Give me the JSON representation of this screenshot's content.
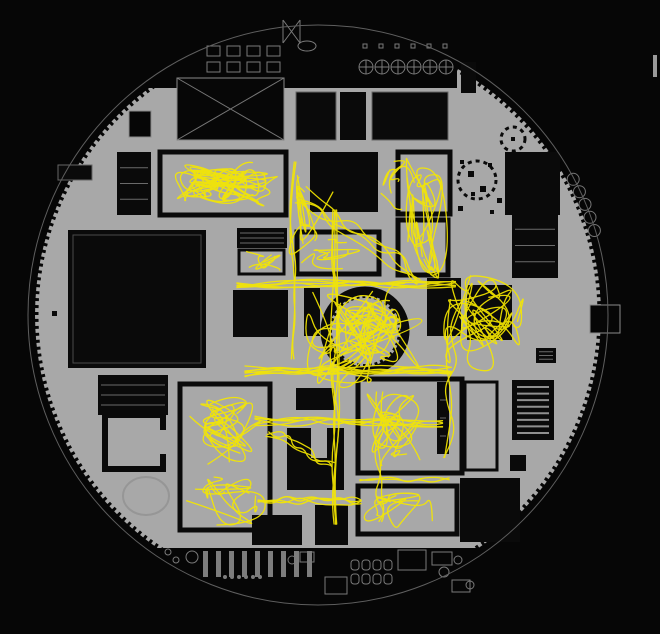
{
  "meta": {
    "description": "Circular office floor plan with yellow movement traces overlaid",
    "canvas": {
      "width": 660,
      "height": 634
    }
  },
  "colors": {
    "background": "#060606",
    "plate": "#a8a8a8",
    "room": "#0a0a0a",
    "outline_stroke": "#5f5f5f",
    "furniture_stroke": "#7a7a7a",
    "furniture_fill": "#7d7d7d",
    "detail_stroke": "#6a6a6a",
    "trace": "#f5e700"
  },
  "plan": {
    "plate": {
      "cx": 318,
      "cy": 315,
      "r": 283
    },
    "outline": {
      "cx": 318,
      "cy": 315,
      "r": 290
    },
    "rim_tick": {
      "dash": "3 4",
      "width": 7
    },
    "top_band": {
      "x": 0,
      "y": 0,
      "w": 457,
      "h": 88
    },
    "bottom_band": {
      "x": 0,
      "y": 548,
      "w": 660,
      "h": 86
    },
    "rooms": [
      {
        "x": 296,
        "y": 92,
        "w": 40,
        "h": 48,
        "t": "solid",
        "s": 1
      },
      {
        "x": 340,
        "y": 92,
        "w": 26,
        "h": 48,
        "t": "solid"
      },
      {
        "x": 372,
        "y": 92,
        "w": 76,
        "h": 48,
        "t": "solid",
        "s": 1
      },
      {
        "x": 461,
        "y": 62,
        "w": 15,
        "h": 31,
        "t": "solid"
      },
      {
        "x": 129,
        "y": 111,
        "w": 22,
        "h": 26,
        "t": "thin"
      },
      {
        "x": 117,
        "y": 152,
        "w": 34,
        "h": 63,
        "t": "detail"
      },
      {
        "x": 160,
        "y": 152,
        "w": 126,
        "h": 63,
        "t": "open"
      },
      {
        "x": 310,
        "y": 152,
        "w": 68,
        "h": 60,
        "t": "solid"
      },
      {
        "x": 398,
        "y": 152,
        "w": 52,
        "h": 62,
        "t": "open"
      },
      {
        "x": 505,
        "y": 152,
        "w": 55,
        "h": 63,
        "t": "solid"
      },
      {
        "x": 512,
        "y": 213,
        "w": 46,
        "h": 65,
        "t": "detail"
      },
      {
        "x": 68,
        "y": 230,
        "w": 138,
        "h": 138,
        "t": "solid",
        "inner": 1
      },
      {
        "x": 237,
        "y": 228,
        "w": 50,
        "h": 20,
        "t": "detail"
      },
      {
        "x": 239,
        "y": 250,
        "w": 45,
        "h": 24,
        "t": "open3"
      },
      {
        "x": 297,
        "y": 232,
        "w": 82,
        "h": 42,
        "t": "open"
      },
      {
        "x": 398,
        "y": 220,
        "w": 50,
        "h": 55,
        "t": "open"
      },
      {
        "x": 233,
        "y": 290,
        "w": 55,
        "h": 47,
        "t": "solid"
      },
      {
        "x": 304,
        "y": 288,
        "w": 16,
        "h": 48,
        "t": "solid"
      },
      {
        "x": 427,
        "y": 278,
        "w": 34,
        "h": 58,
        "t": "solid"
      },
      {
        "x": 467,
        "y": 285,
        "w": 45,
        "h": 55,
        "t": "solid"
      },
      {
        "x": 536,
        "y": 348,
        "w": 20,
        "h": 15,
        "t": "detail"
      },
      {
        "x": 296,
        "y": 388,
        "w": 38,
        "h": 22,
        "t": "solid"
      },
      {
        "x": 98,
        "y": 375,
        "w": 70,
        "h": 40,
        "t": "detail"
      },
      {
        "x": 180,
        "y": 384,
        "w": 90,
        "h": 146,
        "t": "open"
      },
      {
        "x": 358,
        "y": 379,
        "w": 104,
        "h": 94,
        "t": "open"
      },
      {
        "x": 437,
        "y": 382,
        "w": 12,
        "h": 72,
        "t": "detail"
      },
      {
        "x": 358,
        "y": 486,
        "w": 99,
        "h": 48,
        "t": "open"
      },
      {
        "x": 465,
        "y": 382,
        "w": 32,
        "h": 88,
        "t": "open3"
      },
      {
        "x": 460,
        "y": 478,
        "w": 60,
        "h": 64,
        "t": "solid"
      },
      {
        "x": 510,
        "y": 455,
        "w": 16,
        "h": 16,
        "t": "solid"
      },
      {
        "x": 252,
        "y": 515,
        "w": 50,
        "h": 30,
        "t": "solid"
      },
      {
        "x": 315,
        "y": 505,
        "w": 33,
        "h": 40,
        "t": "solid"
      },
      {
        "x": 58,
        "y": 165,
        "w": 34,
        "h": 15,
        "t": "solid",
        "s": 1
      },
      {
        "x": 52,
        "y": 311,
        "w": 5,
        "h": 5,
        "t": "solid"
      },
      {
        "x": 590,
        "y": 305,
        "w": 30,
        "h": 28,
        "t": "thin"
      },
      {
        "x": 653,
        "y": 55,
        "w": 4,
        "h": 22,
        "t": "gray"
      }
    ],
    "xbox": {
      "x": 177,
      "y": 78,
      "w": 107,
      "h": 62
    },
    "trees": [
      {
        "cx": 477,
        "cy": 180,
        "r": 19
      },
      {
        "cx": 513,
        "cy": 139,
        "r": 12
      }
    ],
    "tree_dots": [
      {
        "x": 468,
        "y": 171,
        "s": 6
      },
      {
        "x": 480,
        "y": 186,
        "s": 6
      },
      {
        "x": 471,
        "y": 192,
        "s": 4
      },
      {
        "x": 458,
        "y": 206,
        "s": 5
      },
      {
        "x": 488,
        "y": 163,
        "s": 4
      },
      {
        "x": 497,
        "y": 198,
        "s": 5
      },
      {
        "x": 460,
        "y": 160,
        "s": 4
      },
      {
        "x": 490,
        "y": 210,
        "s": 4
      },
      {
        "x": 511,
        "y": 137,
        "s": 4
      }
    ],
    "core": {
      "cx": 365,
      "cy": 331,
      "r": 40
    },
    "louver": {
      "x": 512,
      "y": 380,
      "w": 42,
      "h": 60,
      "slats": 8
    },
    "notch_room": {
      "x": 287,
      "y": 428,
      "w": 57,
      "h": 62,
      "notch": {
        "x": 311,
        "y": 428,
        "w": 16,
        "h": 30
      }
    },
    "c_room": {
      "x": 105,
      "y": 415,
      "w": 58,
      "h": 54,
      "gap": {
        "x": 155,
        "y": 430,
        "w": 12,
        "h": 24
      }
    },
    "faint_circle": {
      "cx": 146,
      "cy": 496,
      "rx": 23,
      "ry": 19
    },
    "scallops": {
      "start_deg": -28,
      "step_deg": 2.75,
      "count": 5,
      "r": 6
    },
    "furniture": {
      "tables_top": {
        "x0": 207,
        "dx": 20,
        "cols": 4,
        "rows": [
          46,
          62
        ],
        "w": 13,
        "h": 10
      },
      "pods": {
        "x0": 366,
        "dx": 16,
        "count": 6,
        "cy": 67,
        "r": 7
      },
      "chairs": {
        "x0": 363,
        "dx": 16,
        "count": 6,
        "y": 44,
        "s": 4
      },
      "conference": {
        "cx": 307,
        "cy": 46,
        "rx": 9,
        "ry": 5
      },
      "bowtie": "M283,20 L300,43 M300,20 L283,43 M283,20 L283,43 M300,20 L300,43",
      "bars": {
        "x0": 203,
        "dx": 13,
        "count": 9,
        "y": 551,
        "w": 5,
        "h": 26
      },
      "dots_row": {
        "x0": 225,
        "dx": 7,
        "count": 6,
        "cy": 577,
        "r": 2
      },
      "zeros": {
        "x0": 351,
        "y0": 560,
        "cols": 4,
        "rows": 2,
        "dx": 11,
        "dy": 14,
        "w": 8,
        "h": 10
      },
      "rects": [
        {
          "x": 325,
          "y": 577,
          "w": 22,
          "h": 17
        },
        {
          "x": 300,
          "y": 552,
          "w": 14,
          "h": 10
        },
        {
          "x": 398,
          "y": 550,
          "w": 28,
          "h": 20
        },
        {
          "x": 432,
          "y": 552,
          "w": 20,
          "h": 13
        },
        {
          "x": 452,
          "y": 580,
          "w": 18,
          "h": 12
        }
      ],
      "circles": [
        {
          "cx": 192,
          "cy": 557,
          "r": 6
        },
        {
          "cx": 292,
          "cy": 560,
          "r": 4
        },
        {
          "cx": 444,
          "cy": 572,
          "r": 5
        },
        {
          "cx": 458,
          "cy": 560,
          "r": 4
        },
        {
          "cx": 470,
          "cy": 585,
          "r": 4
        },
        {
          "cx": 168,
          "cy": 552,
          "r": 3
        },
        {
          "cx": 176,
          "cy": 560,
          "r": 3
        }
      ]
    }
  },
  "traces": {
    "width": 1.3,
    "opacity": 0.92,
    "scribbles": [
      {
        "x": 168,
        "y": 158,
        "w": 115,
        "h": 52,
        "n": 26,
        "seed": 11
      },
      {
        "x": 283,
        "y": 168,
        "w": 50,
        "h": 100,
        "n": 9,
        "seed": 12
      },
      {
        "x": 404,
        "y": 155,
        "w": 50,
        "h": 140,
        "n": 16,
        "seed": 13
      },
      {
        "x": 378,
        "y": 158,
        "w": 45,
        "h": 55,
        "n": 5,
        "seed": 14
      },
      {
        "x": 300,
        "y": 238,
        "w": 80,
        "h": 34,
        "n": 6,
        "seed": 15
      },
      {
        "x": 432,
        "y": 268,
        "w": 100,
        "h": 105,
        "n": 18,
        "seed": 16
      },
      {
        "x": 298,
        "y": 278,
        "w": 135,
        "h": 118,
        "n": 22,
        "seed": 17
      },
      {
        "x": 332,
        "y": 302,
        "w": 68,
        "h": 58,
        "n": 10,
        "seed": 18
      },
      {
        "x": 185,
        "y": 392,
        "w": 85,
        "h": 75,
        "n": 14,
        "seed": 19
      },
      {
        "x": 185,
        "y": 470,
        "w": 85,
        "h": 60,
        "n": 11,
        "seed": 20
      },
      {
        "x": 362,
        "y": 386,
        "w": 72,
        "h": 82,
        "n": 13,
        "seed": 21
      },
      {
        "x": 362,
        "y": 490,
        "w": 90,
        "h": 46,
        "n": 9,
        "seed": 22
      },
      {
        "x": 243,
        "y": 250,
        "w": 40,
        "h": 24,
        "n": 5,
        "seed": 23
      }
    ],
    "corridors": [
      {
        "x1": 300,
        "y1": 196,
        "x2": 430,
        "y2": 282,
        "strands": 4,
        "jitter": 12,
        "seed": 31
      },
      {
        "x1": 237,
        "y1": 284,
        "x2": 470,
        "y2": 284,
        "strands": 6,
        "jitter": 5,
        "seed": 32
      },
      {
        "x1": 245,
        "y1": 371,
        "x2": 465,
        "y2": 369,
        "strands": 7,
        "jitter": 6,
        "seed": 33
      },
      {
        "x1": 334,
        "y1": 210,
        "x2": 336,
        "y2": 545,
        "strands": 4,
        "jitter": 5,
        "seed": 34
      },
      {
        "x1": 292,
        "y1": 162,
        "x2": 294,
        "y2": 372,
        "strands": 2,
        "jitter": 4,
        "seed": 35
      },
      {
        "x1": 255,
        "y1": 421,
        "x2": 455,
        "y2": 423,
        "strands": 5,
        "jitter": 5,
        "seed": 36
      },
      {
        "x1": 258,
        "y1": 500,
        "x2": 368,
        "y2": 500,
        "strands": 4,
        "jitter": 6,
        "seed": 37
      },
      {
        "x1": 380,
        "y1": 392,
        "x2": 380,
        "y2": 530,
        "strands": 2,
        "jitter": 8,
        "seed": 38
      },
      {
        "x1": 455,
        "y1": 300,
        "x2": 445,
        "y2": 468,
        "strands": 2,
        "jitter": 8,
        "seed": 39
      },
      {
        "x1": 270,
        "y1": 430,
        "x2": 335,
        "y2": 470,
        "strands": 3,
        "jitter": 8,
        "seed": 40
      },
      {
        "x1": 360,
        "y1": 478,
        "x2": 455,
        "y2": 480,
        "strands": 2,
        "jitter": 4,
        "seed": 41
      }
    ]
  }
}
